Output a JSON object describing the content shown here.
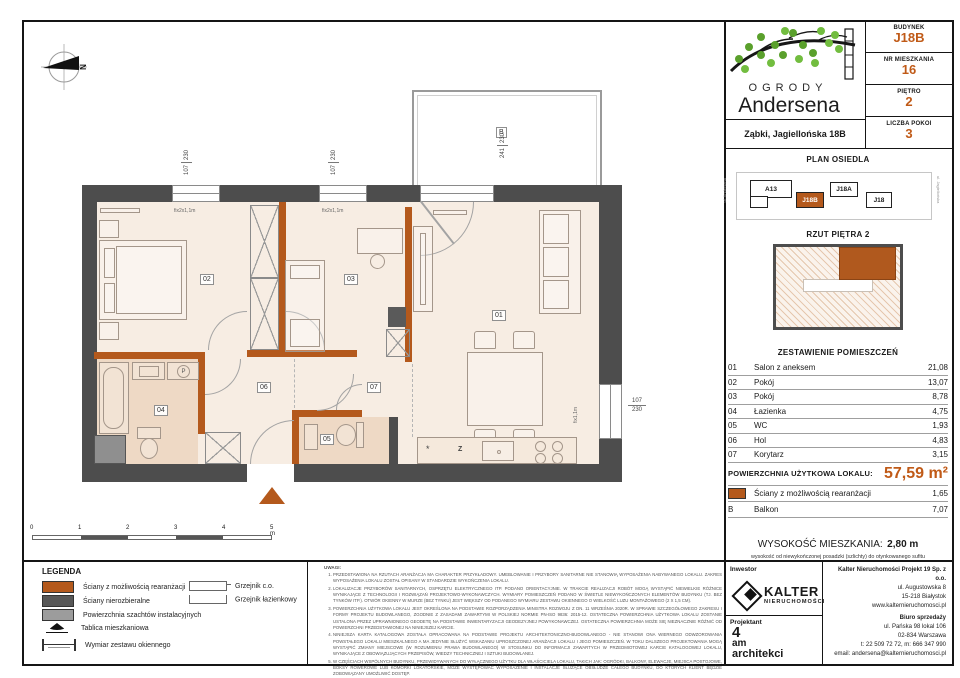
{
  "header": {
    "brand_line1": "OGRODY",
    "brand_line2": "Andersena",
    "address": "Ząbki, Jagiellońska 18B",
    "fields": [
      {
        "label": "BUDYNEK",
        "value": "J18B"
      },
      {
        "label": "NR MIESZKANIA",
        "value": "16"
      },
      {
        "label": "PIĘTRO",
        "value": "2"
      },
      {
        "label": "LICZBA POKOI",
        "value": "3"
      }
    ]
  },
  "site_plan": {
    "title": "PLAN OSIEDLA",
    "street_left": "ul. Andersena",
    "street_right": "ul. Jagiellońska",
    "buildings": [
      {
        "label": "A13"
      },
      {
        "label": "J18B"
      },
      {
        "label": "J18A"
      },
      {
        "label": "J18"
      }
    ]
  },
  "floor_thumb": {
    "title": "RZUT PIĘTRA 2"
  },
  "rooms": {
    "title": "ZESTAWIENIE POMIESZCZEŃ",
    "rows": [
      {
        "no": "01",
        "name": "Salon z aneksem",
        "area": "21,08"
      },
      {
        "no": "02",
        "name": "Pokój",
        "area": "13,07"
      },
      {
        "no": "03",
        "name": "Pokój",
        "area": "8,78"
      },
      {
        "no": "04",
        "name": "Łazienka",
        "area": "4,75"
      },
      {
        "no": "05",
        "name": "WC",
        "area": "1,93"
      },
      {
        "no": "06",
        "name": "Hol",
        "area": "4,83"
      },
      {
        "no": "07",
        "name": "Korytarz",
        "area": "3,15"
      }
    ],
    "total_label": "POWIERZCHNIA UŻYTKOWA LOKALU:",
    "total_value": "57,59 m²",
    "walls_row": {
      "name": "Ściany z możliwością rearanżacji",
      "area": "1,65"
    },
    "balcony_row": {
      "no": "B",
      "name": "Balkon",
      "area": "7,07"
    }
  },
  "height": {
    "label": "WYSOKOŚĆ MIESZKANIA:",
    "value": "2,80 m",
    "subtitle": "wysokość od niewykończonej posadzki (szlichty) do otynkowanego sufitu"
  },
  "legend": {
    "title": "LEGENDA",
    "items": [
      "Ściany z możliwością rearanżacji",
      "Ściany nierozbieralne",
      "Powierzchnia szachtów instalacyjnych",
      "Tablica mieszkaniowa",
      "Wymiar zestawu okiennego"
    ],
    "items_right": [
      "Grzejnik c.o.",
      "Grzejnik łazienkowy"
    ]
  },
  "notes": {
    "title": "UWAGI:",
    "items": [
      "PRZEDSTAWIONA NA RZUTACH ARANŻACJA MA CHARAKTER PRZYKŁADOWY. UMEBLOWANIE I PRZYBORY SANITARNE NIE STANOWIĄ WYPOSAŻENIA NABYWANEGO LOKALU. ZAKRES WYPOSAŻENIA LOKALU ZOSTAŁ OPISANY W STANDARDZIE WYKOŃCZENIA LOKALU.",
      "LOKALIZACJE PRZYBORÓW SANITARNYCH, OSPRZĘTU ELEKTRYCZNEGO ITP. PODANO ORIENTACYJNIE. W TRAKCIE REALIZACJI ROBÓT MOGĄ WYSTĄPIĆ NIEWIELKIE RÓŻNICE WYNIKAJĄCE Z TECHNOLOGII I ROZWIĄZAŃ PROJEKTOWO-WYKONAWCZYCH. WYMIARY POMIESZCZEŃ PODANO W ŚWIETLE NIEWYKOŃCZONYCH ELEMENTÓW BUDYNKU (TJ. BEZ TYNKÓW ITP.). OTWÓR OKIENNY W MURZE (BEZ TYNKU) JEST WIĘKSZY OD PODANEGO WYMIARU ZESTAWU OKIENNEGO O WIELKOŚĆ LUZU MONTAŻOWEGO (2 X 1,5 CM).",
      "POWIERZCHNIA UŻYTKOWA LOKALU JEST OKREŚLONA NA PODSTAWIE ROZPORZĄDZENIA MINISTRA ROZWOJU Z DN. 11 WRZEŚNIA 2020R. W SPRAWIE SZCZEGÓŁOWEGO ZAKRESU I FORMY PROJEKTU BUDOWLANEGO, ZGODNIE Z ZASADAMI ZAWARTYMI W POLSKIEJ NORMIE PN-ISO 9836: 2015-12. OSTATECZNA POWIERZCHNIA UŻYTKOWA LOKALU ZOSTANIE USTALONA PRZEZ UPRAWNIONEGO GEODETĘ NA PODSTAWIE INWENTARYZACJI GEODEZYJNEJ POWYKONAWCZEJ. OSTATECZNA POWIERZCHNIA MOŻE SIĘ NIEZNACZNIE RÓŻNIĆ OD POWIERZCHNI PRZEDSTAWIONEJ NA NINIEJSZEJ KARCIE.",
      "NINIEJSZA KARTA KATALOGOWA ZOSTAŁA OPRACOWANA NA PODSTAWIE PROJEKTU ARCHITEKTONICZNO-BUDOWLANEGO - NIE STANOWI ONA WIERNEGO ODWZOROWANIA POWSTAŁEGO LOKALU MIESZKALNEGO A MA JEDYNIE SŁUŻYĆ WSKAZANIU UPROSZCZONEJ ARANŻACJI LOKALU I JEGO POMIESZCZEŃ. W TOKU DALSZEGO PROJEKTOWANIA MOGĄ WYSTĄPIĆ ZMIANY MIEJSCOWE (W ROZUMIENIU PRAWA BUDOWLANEGO) W STOSUNKU DO INFORMACJI ZAWARTYCH W PRZEDMIOTOWEJ KARCIE KATALOGOWEJ LOKALU, WYNIKAJĄCE Z OBOWIĄZUJĄCYCH PRZEPISÓW, WIEDZY TECHNICZNEJ I SZTUKI BUDOWLANEJ.",
      "W CZĘŚCIACH WSPÓLNYCH BUDYNKU, PRZEWIDYWANYCH DO WYŁĄCZNEGO UŻYTKU DLA WŁAŚCICIELA LOKALU, TAKICH JAK: OGRÓDKI, BALKONY, ELEWACJE, MIEJSCA POSTOJOWE, BOKSY ROWEROWE LUB KOMÓRKI LOKATORSKIE, MOŻE WYSTĘPOWAĆ WYPOSAŻENIE I INSTALACJE SŁUŻĄCE OBSŁUDZE CAŁEGO BUDYNKU, DO KTÓRYCH KLIENT BĘDZIE ZOBOWIĄZANY UMOŻLIWIĆ DOSTĘP.",
      "NINIEJSZA KARTA NIE PRZEDSTAWIA KOMPLETNEGO PROJEKTU WIELOBRANŻOWEGO. RYSUNEK NIE JEST PRZEZNACZONY DO CELÓW WYKONAWCZYCH. SZCZEGÓŁOWE INFORMACJE PROJEKTOWE ZNAJDUJĄ SIĘ W DOKUMENTACJI TECHNICZNO-WYKONAWCZEJ DOSTĘPNEJ DO WGLĄDU DLA KLIENTÓW W BIURZE INWESTORA.",
      "PROJEKT CHRONIONY PRAWEM AUTORSKIM."
    ]
  },
  "footer": {
    "investor_label": "Inwestor",
    "investor_name": "KALTER",
    "investor_tagline": "nieruchomości",
    "designer_label": "Projektant",
    "designer_line1": "4",
    "designer_line2": "am",
    "designer_line3": "architekci",
    "company_name": "Kalter Nieruchomości Projekt 19 Sp. z o.o.",
    "company_addr1": "ul. Augustowska 8",
    "company_addr2": "15-218 Białystok",
    "company_web": "www.kalternieruchomosci.pl",
    "sales_title": "Biuro sprzedaży",
    "sales_addr1": "ul. Pańska 98 lokal 106",
    "sales_addr2": "02-834 Warszawa",
    "sales_phone": "t: 22 509 72 72, m: 666 347 990",
    "sales_email": "email: andersena@kalternieruchomosci.pl"
  },
  "plan": {
    "compass": "N",
    "balcony_label": "B",
    "room_labels": {
      "r01": "01",
      "r02": "02",
      "r03": "03",
      "r04": "04",
      "r05": "05",
      "r06": "06",
      "r07": "07"
    },
    "appliances": {
      "washer": "P",
      "dishwasher": "Z",
      "fridge": "*"
    },
    "window_dims": {
      "w1a": "107",
      "w1b": "230",
      "w2a": "107",
      "w2b": "230",
      "w3a": "241",
      "w3b": "230",
      "w4a": "107",
      "w4b": "230"
    },
    "fix_labels": {
      "f1": "fix2x1,1m",
      "f2": "fix2x1,1m",
      "f3": "fix1,1m"
    },
    "scale_ticks": [
      "0",
      "1",
      "2",
      "3",
      "4",
      "5 m"
    ]
  },
  "colors": {
    "accent": "#c05a17",
    "wall_orange": "#b4591c",
    "wall_dark": "#4d4d4d",
    "room_fill": "#f7ede3",
    "wet_fill": "#eed9c5",
    "shaft_gray": "#8f8f8f"
  }
}
